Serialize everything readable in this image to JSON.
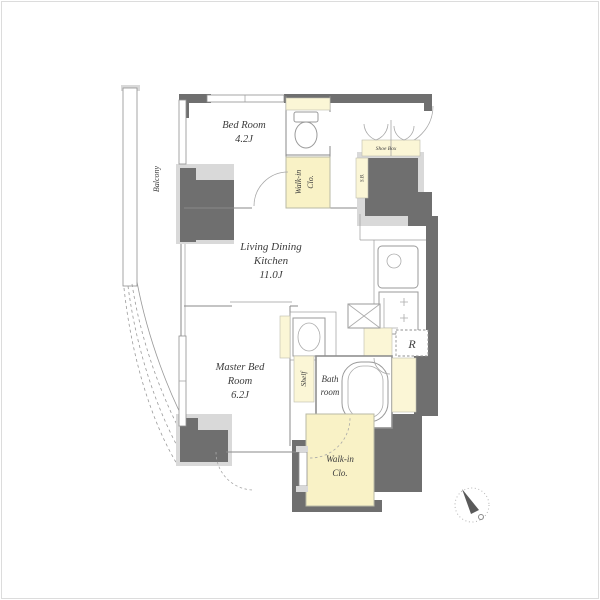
{
  "colors": {
    "wall_dark": "#6f6f6f",
    "wall_light": "#d9d9d9",
    "closet_yellow": "#f9f2c6",
    "strip_yellow": "#fbf6d6",
    "line_gray": "#8a8a8a",
    "text_gray": "#3c3c3c",
    "background": "#ffffff"
  },
  "rooms": {
    "bed_room": {
      "name": "Bed Room",
      "size": "4.2J"
    },
    "balcony": {
      "name": "Balcony"
    },
    "walk_in_closet_upper": {
      "line1": "Walk-in",
      "line2": "Clo."
    },
    "living_dining_kitchen": {
      "line1": "Living Dining",
      "line2": "Kitchen",
      "size": "11.0J"
    },
    "master_bed_room": {
      "line1": "Master Bed",
      "line2": "Room",
      "size": "6.2J"
    },
    "shelf": {
      "name": "Shelf"
    },
    "bath_room": {
      "line1": "Bath",
      "line2": "room"
    },
    "walk_in_closet_lower": {
      "line1": "Walk-in",
      "line2": "Clo."
    }
  },
  "fixtures": {
    "shoe_box_label": "Shoe Box",
    "storage_strip_label": "S.B.",
    "refrigerator_label": "R"
  },
  "icons": {
    "compass": "north-compass-icon",
    "toilet": "toilet-icon",
    "kitchen_sink": "kitchen-sink-icon",
    "stove": "stove-icon",
    "vanity": "washbasin-icon",
    "washer": "washing-machine-pan-icon",
    "bathtub": "bathtub-icon"
  }
}
